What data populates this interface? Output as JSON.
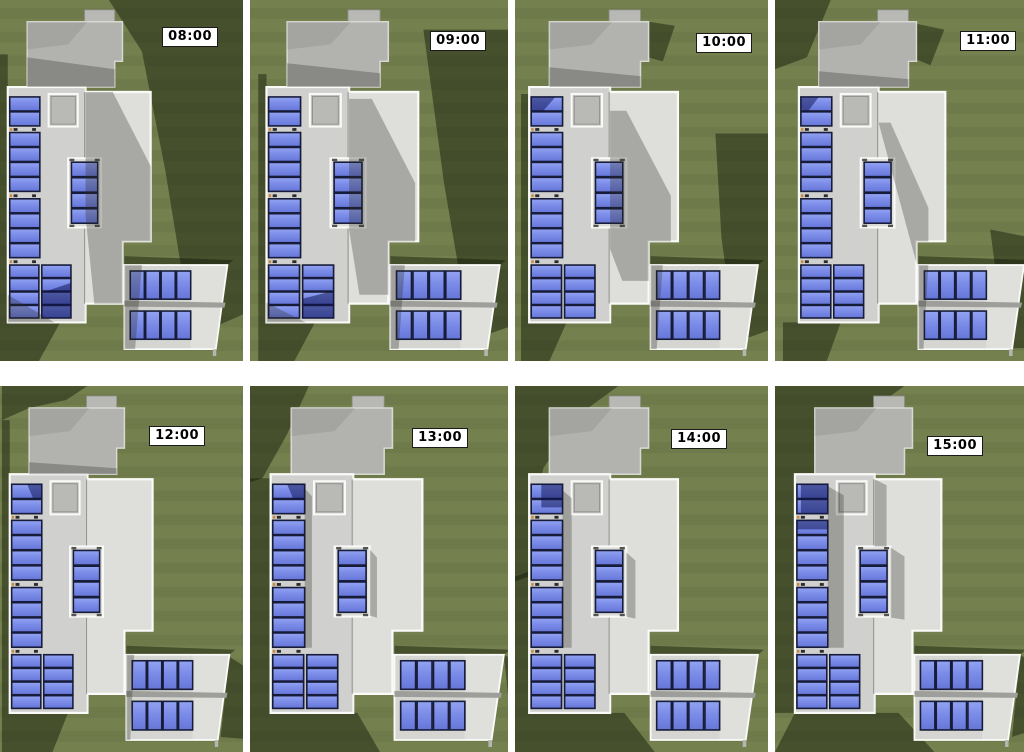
{
  "figure": {
    "description": "Solar shading study montage: plan view of a house with rooftop PV arrays and a carport array, rendered at eight times of day",
    "grid": {
      "rows": 2,
      "cols": 4
    }
  },
  "arrays": {
    "left_column_single_panels": 10,
    "left_bottom_block": "4 rows x 2 columns",
    "middle_array_panels": 4,
    "carport_array": "2 rows x 4 panels"
  },
  "colors": {
    "lawn": "#75804f",
    "lawn_stripe": "rgba(0,0,0,0.045)",
    "lawn_shadow": "rgba(16,24,6,0.46)",
    "roof_main": "#dededb",
    "roof_left_tint": "rgba(0,0,0,0.06)",
    "roof_upper": "#b2b2af",
    "chimney": "#b8b8b5",
    "skylight": "#c3c3c0",
    "deck": "#d5d5d1",
    "deck_highlight": "rgba(255,255,255,0.25)",
    "beam": "#9e9e9a",
    "outline": "#fafaf8",
    "panel_blue_top": "#93a3f2",
    "panel_blue_mid": "#7b8ce8",
    "panel_blue_bottom": "#6676d8",
    "panel_frame": "#171c38",
    "bracket": "#2b2b2b",
    "bracket_clip": "#c98a3e",
    "roof_shadow": "rgba(42,44,36,0.30)",
    "panel_shadow": "rgba(16,22,84,0.52)",
    "label_bg": "#ffffff",
    "label_border": "#1a1a1a",
    "label_text": "#000000"
  },
  "tiles": [
    {
      "time": "08:00",
      "offset_x": 0,
      "label_top": 27,
      "label_right": 25,
      "lawn_shadows": [
        "112,0 250,0 250,318 198,340 170,172 146,52",
        "0,55 8,55 8,326 0,326",
        "0,326 62,326 40,365 0,365"
      ],
      "roof_shadows": [
        "88,93 116,93 155,168 155,244 126,244 126,307 97,307 88,218",
        "28,58 118,70 118,88 28,88",
        "8,298 56,326 8,326",
        "128,268 146,268 139,353 128,353"
      ],
      "panel_shadows": [
        "43,296 73,286 73,321 43,321"
      ]
    },
    {
      "time": "09:00",
      "offset_x": 8,
      "label_top": 31,
      "label_right": 22,
      "lawn_shadows": [
        "160,30 250,30 250,328 206,344 180,185",
        "0,75 8,75 8,326 0,326",
        "0,326 55,326 35,365 0,365"
      ],
      "roof_shadows": [
        "88,100 110,100 152,185 152,244 126,244 126,298 98,298 88,232",
        "28,64 118,74 118,88 28,88",
        "8,306 46,326 8,326",
        "128,268 142,268 136,353 128,353"
      ],
      "panel_shadows": [
        "43,302 73,294 73,321 43,321"
      ]
    },
    {
      "time": "10:00",
      "offset_x": 6,
      "label_top": 33,
      "label_right": 16,
      "lawn_shadows": [
        "192,135 250,135 250,332 212,346 198,240",
        "0,95 8,95 8,326 0,326",
        "126,22 152,26 140,62 126,58",
        "0,326 45,326 28,365 0,365"
      ],
      "roof_shadows": [
        "88,112 104,112 148,198 148,244 126,244 126,284 100,284 88,252",
        "28,68 118,77 118,88 28,88",
        "128,268 140,268 134,353 128,353"
      ],
      "panel_shadows": [
        "10,98 34,98 22,112 10,112"
      ]
    },
    {
      "time": "11:00",
      "offset_x": 16,
      "label_top": 31,
      "label_right": 8,
      "lawn_shadows": [
        "200,232 250,242 250,352 216,352",
        "-16,0 40,0 16,58 -16,70",
        "126,24 154,30 140,66 126,60",
        "-8,326 50,326 36,365 -8,365"
      ],
      "roof_shadows": [
        "88,124 100,124 138,210 138,244 126,244 126,266",
        "28,72 118,80 118,88 28,88",
        "128,268 138,268 133,353 128,353"
      ],
      "panel_shadows": [
        "10,98 28,98 16,114 10,110"
      ]
    },
    {
      "time": "12:00",
      "offset_x": 2,
      "label_top": 40,
      "label_right": 38,
      "lawn_shadows": [
        "0,0 88,0 66,14 28,22 0,34",
        "0,34 8,34 8,326 0,326",
        "234,270 250,280 250,352 225,350",
        "0,326 68,326 52,365 0,365"
      ],
      "roof_shadows": [
        "28,76 118,82 118,88 28,88",
        "128,268 136,268 132,353 128,353"
      ],
      "panel_shadows": [
        "26,98 41,98 41,112 32,112"
      ]
    },
    {
      "time": "13:00",
      "offset_x": 12,
      "label_top": 42,
      "label_right": 40,
      "lawn_shadows": [
        "-12,0 45,0 24,48 0,92 -12,96",
        "-12,92 8,92 8,365 -12,365",
        "8,326 92,326 114,365 8,365",
        "234,268 250,277 250,326 238,308"
      ],
      "roof_shadows": [
        "41,102 48,110 48,261 41,261",
        "104,163 111,171 111,231 104,229"
      ],
      "panel_shadows": [
        "24,98 41,98 41,113 30,113"
      ]
    },
    {
      "time": "14:00",
      "offset_x": 6,
      "label_top": 43,
      "label_right": 41,
      "lawn_shadows": [
        "-6,0 96,0 58,28 22,82 8,140 8,190 -6,195",
        "-6,190 8,185 8,365 -6,365",
        "8,326 102,326 132,365 8,365"
      ],
      "roof_shadows": [
        "41,104 50,112 50,261 41,261",
        "104,166 113,174 113,232 104,230"
      ],
      "panel_shadows": [
        "20,98 41,98 41,121 20,121"
      ]
    },
    {
      "time": "15:00",
      "offset_x": 12,
      "label_top": 50,
      "label_right": 41,
      "lawn_shadows": [
        "-12,0 118,0 56,44 18,108 8,180 8,326 -12,326",
        "8,326 112,326 148,365 -12,365",
        "234,268 250,278 250,342 226,350"
      ],
      "roof_shadows": [
        "41,100 57,109 57,261 41,261",
        "104,161 118,170 118,233 104,231",
        "88,93 100,99 100,160 88,160"
      ],
      "panel_shadows": [
        "14,98 41,98 41,127 14,127",
        "10,134 41,134 41,143 10,143"
      ]
    }
  ]
}
